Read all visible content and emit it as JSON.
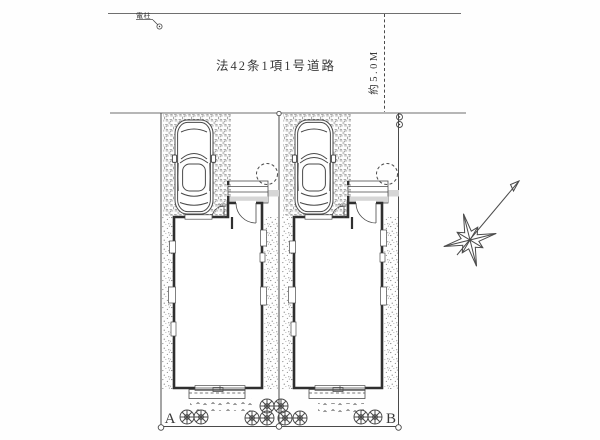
{
  "document": {
    "type": "residential-site-plan",
    "road": {
      "label": "法42条1項1号道路",
      "width_label": "約5.0M",
      "pole_label": "電柱"
    },
    "lots": [
      {
        "id": "A",
        "label": "A",
        "entry_dim": "935"
      },
      {
        "id": "B",
        "label": "B",
        "entry_dim": "935"
      }
    ],
    "icons": {
      "compass": "compass-rose-with-north-needle",
      "car": "car-top-view",
      "tree": "round-tree-shrub-symbol",
      "utility_pole": "utility-pole-circle-symbol",
      "survey_marker": "survey-point-circle"
    },
    "colors": {
      "paper": "#fefefe",
      "ink": "#4a4a4a",
      "wall": "#2f2f2f",
      "light": "#d6d6d6"
    }
  }
}
